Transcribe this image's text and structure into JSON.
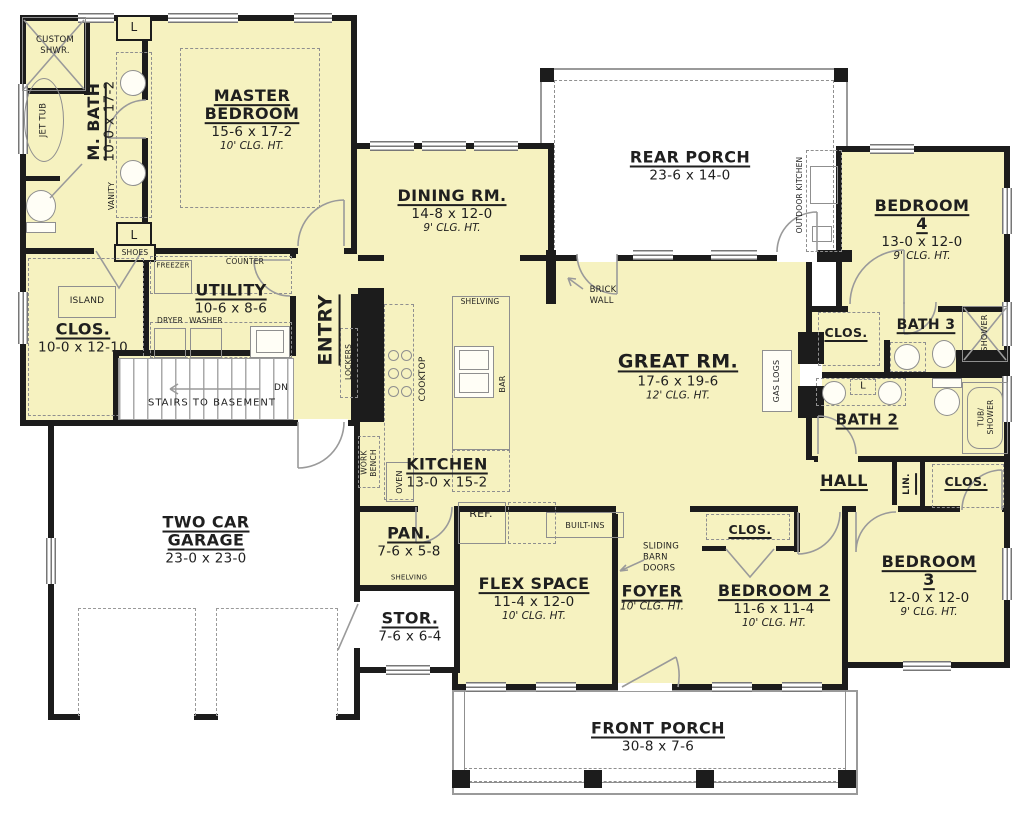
{
  "plan": {
    "colors": {
      "floor": "#f6f2c0",
      "wall": "#1c1c1c",
      "fixture_outline": "#8f8f8f",
      "open_area": "#ffffff"
    },
    "rooms": {
      "master_bedroom": {
        "name": "MASTER\nBEDROOM",
        "dims": "15-6 x 17-2",
        "clg": "10' CLG. HT."
      },
      "m_bath": {
        "name": "M. BATH",
        "dims": "10-0 x 17-2"
      },
      "dining": {
        "name": "DINING RM.",
        "dims": "14-8 x 12-0",
        "clg": "9' CLG. HT."
      },
      "rear_porch": {
        "name": "REAR PORCH",
        "dims": "23-6 x 14-0"
      },
      "bedroom4": {
        "name": "BEDROOM 4",
        "dims": "13-0 x 12-0",
        "clg": "9' CLG. HT."
      },
      "utility": {
        "name": "UTILITY",
        "dims": "10-6 x 8-6"
      },
      "closet_master": {
        "name": "CLOS.",
        "dims": "10-0 x 12-10"
      },
      "great_room": {
        "name": "GREAT RM.",
        "dims": "17-6 x 19-6",
        "clg": "12' CLG. HT."
      },
      "kitchen": {
        "name": "KITCHEN",
        "dims": "13-0 x 15-2"
      },
      "bath3": {
        "name": "BATH 3"
      },
      "clos_bath3": {
        "name": "CLOS."
      },
      "bath2": {
        "name": "BATH 2"
      },
      "hall": {
        "name": "HALL"
      },
      "lin": {
        "name": "LIN."
      },
      "clos_hall": {
        "name": "CLOS."
      },
      "garage": {
        "name": "TWO CAR\nGARAGE",
        "dims": "23-0 x 23-0"
      },
      "pantry": {
        "name": "PAN.",
        "dims": "7-6 x 5-8"
      },
      "storage": {
        "name": "STOR.",
        "dims": "7-6 x 6-4"
      },
      "flex": {
        "name": "FLEX SPACE",
        "dims": "11-4 x 12-0",
        "clg": "10' CLG. HT."
      },
      "foyer": {
        "name": "FOYER",
        "clg": "10' CLG. HT."
      },
      "bedroom2": {
        "name": "BEDROOM 2",
        "dims": "11-6 x 11-4",
        "clg": "10' CLG. HT."
      },
      "clos_bd2": {
        "name": "CLOS."
      },
      "bedroom3": {
        "name": "BEDROOM 3",
        "dims": "12-0 x 12-0",
        "clg": "9' CLG. HT."
      },
      "front_porch": {
        "name": "FRONT PORCH",
        "dims": "30-8 x 7-6"
      },
      "entry": {
        "name": "ENTRY"
      }
    },
    "ann": {
      "custom_shwr": "CUSTOM\nSHWR.",
      "jet_tub": "JET TUB",
      "l": "L",
      "vanity": "VANITY",
      "shoes": "SHOES",
      "freezer": "FREEZER",
      "counter": "COUNTER",
      "dryer": "DRYER",
      "washer": "WASHER",
      "island": "ISLAND",
      "stairs": "STAIRS TO BASEMENT",
      "dn": "DN",
      "lockers": "LOCKERS",
      "cooktop": "COOKTOP",
      "shelving": "SHELVING",
      "bar": "BAR",
      "work_bench": "WORK\nBENCH",
      "oven": "OVEN",
      "ref": "REF.",
      "built_ins": "BUILT-INS",
      "barn": "SLIDING\nBARN\nDOORS",
      "brick": "BRICK\nWALL",
      "outdoor_kitchen": "OUTDOOR KITCHEN",
      "gas_logs": "GAS LOGS",
      "shower": "SHOWER",
      "tub_shower": "TUB/\nSHOWER"
    }
  }
}
